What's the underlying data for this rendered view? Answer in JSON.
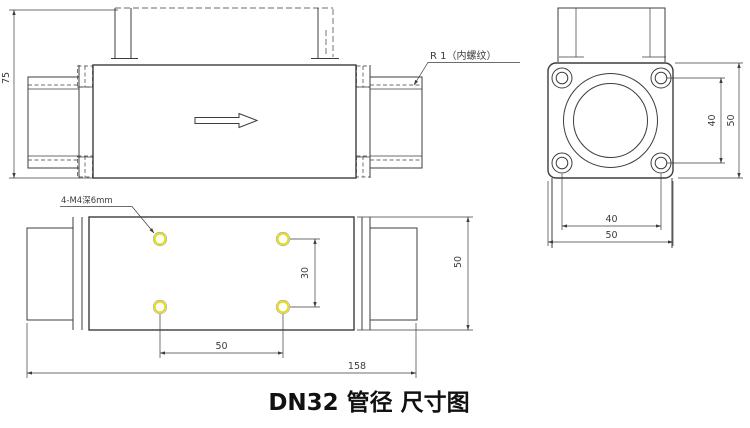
{
  "title": "DN32 管径 尺寸图",
  "colors": {
    "line": "#3d3d3d",
    "hole_highlight": "#e8dc00",
    "background": "#ffffff",
    "title_text": "#111111"
  },
  "side_view": {
    "height_dim": "75",
    "thread_note": "R 1（内螺纹）"
  },
  "end_view": {
    "bolt_spacing_vertical": "40",
    "overall_height": "50",
    "bolt_spacing_horizontal": "40",
    "overall_width": "50"
  },
  "bottom_view": {
    "tapped_holes_note": "4-M4深6mm",
    "hole_spacing_vertical": "30",
    "hole_spacing_horizontal": "50",
    "overall_length": "158",
    "overall_width": "50"
  }
}
